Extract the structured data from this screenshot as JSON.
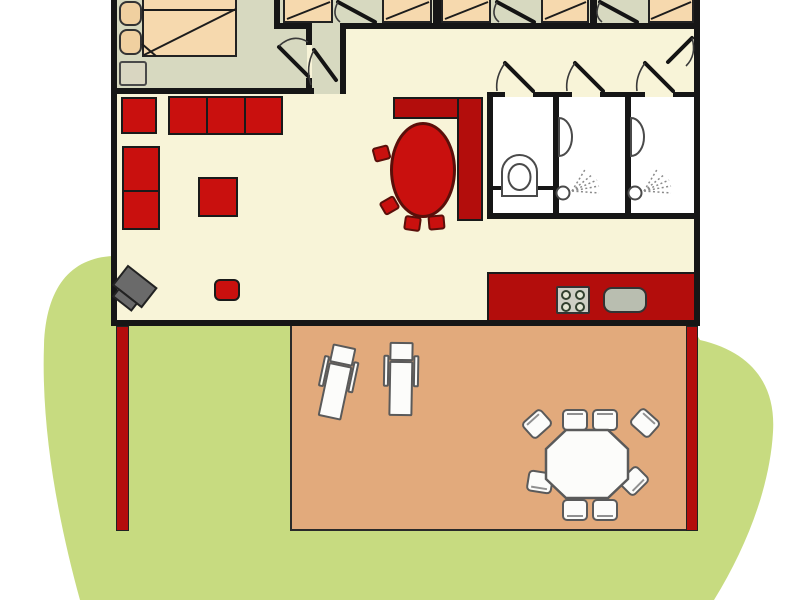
{
  "title": "holiday-bungalow-floor-plan",
  "colors": {
    "background": "#ffffff",
    "lawn": "#c7db80",
    "wall": "#161616",
    "floor": "#f8f4d8",
    "floor_bedroom": "#d7d9c0",
    "bed": "#f6d9ae",
    "pillow": "#f0d0a0",
    "nightstand": "#d9d6c1",
    "furniture_red": "#c9100e",
    "counter_red": "#b30d0c",
    "accent_dark_red": "#5a0f0a",
    "terrace": "#e2aa7c",
    "bathroom": "#ffffff",
    "fixture_outline": "#4a4a4a",
    "outdoor_white": "#fcfcfa",
    "outdoor_outline": "#5a5a5a",
    "tv_gray": "#6a6a6a",
    "stove_gray": "#cfcfc5",
    "burner_green": "#e4e6d5",
    "sink_gray": "#b9beb0",
    "post_red": "#b30d0c"
  },
  "rooms": [
    "master-bedroom",
    "bedroom-row",
    "corridor",
    "hallway",
    "wc",
    "shower-room-1",
    "shower-room-2",
    "living-dining-room",
    "kitchen",
    "terrace",
    "garden"
  ],
  "symbols": [
    "double-bed",
    "single-bed",
    "pillow",
    "nightstand",
    "door-swing",
    "armchair",
    "sofa-3-seat",
    "sofa-2-seat",
    "ottoman",
    "tv",
    "stool",
    "dining-table-oval",
    "dining-chair",
    "kitchen-counter",
    "stove-4-burner",
    "sink",
    "toilet",
    "wash-basin",
    "shower-spray",
    "sun-lounger",
    "garden-table",
    "garden-chair",
    "lawn",
    "fence-post"
  ]
}
